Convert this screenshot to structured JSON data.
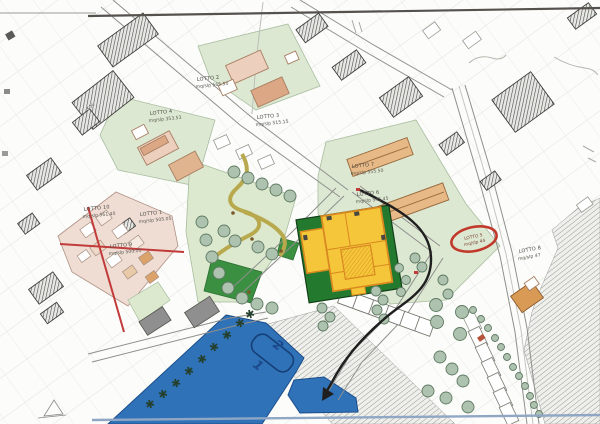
{
  "lots": {
    "lotto2": {
      "name": "LOTTO 2",
      "area": "mq/slp 565.50"
    },
    "lotto4": {
      "name": "LOTTO 4",
      "area": "mq/slp 353.53"
    },
    "lotto3": {
      "name": "LOTTO 3",
      "area": "mq/slp 515.15"
    },
    "lotto10": {
      "name": "LOTTO 10",
      "area": "mq/slp 561.40"
    },
    "lotto1": {
      "name": "LOTTO 1",
      "area": "mq/slp 505.05"
    },
    "lotto9": {
      "name": "LOTTO 9",
      "area": "mq/slp 500.00"
    },
    "lotto7": {
      "name": "LOTTO 7",
      "area": "mq/slp 555.50"
    },
    "lotto6": {
      "name": "LOTTO 6",
      "area": "mq/slp 545.45"
    },
    "lotto5": {
      "name": "LOTTO 5",
      "area": "mq/slp 44"
    },
    "lotto8": {
      "name": "LOTTO 8",
      "area": "mq/slp 47"
    }
  },
  "annotations": {
    "handwritten_numbers": {
      "first": "1",
      "second": "2"
    },
    "building_label": "KSL"
  },
  "colors": {
    "paper": "#fcfcfa",
    "pale_green_block": "#dde8d2",
    "park_green": "#dce9cf",
    "dark_green_lot": "#237a2e",
    "mid_green_patch": "#3a8f41",
    "yellow_building": "#f5c53a",
    "orange_outline": "#d8891f",
    "blue_zone": "#2f72b8",
    "pink_zone": "#efddd4",
    "tan_building": "#e7b986",
    "pink_building": "#ecd0bd",
    "red_annotation": "#c23b3b",
    "handwriting_blue": "#1d4a8c",
    "hatch_gray": "#4a4a48",
    "tree_green": "#aec3af",
    "path_olive": "#b9a94e",
    "arrow_black": "#1f1f1f",
    "scan_line_blue": "#8fa7c4"
  }
}
